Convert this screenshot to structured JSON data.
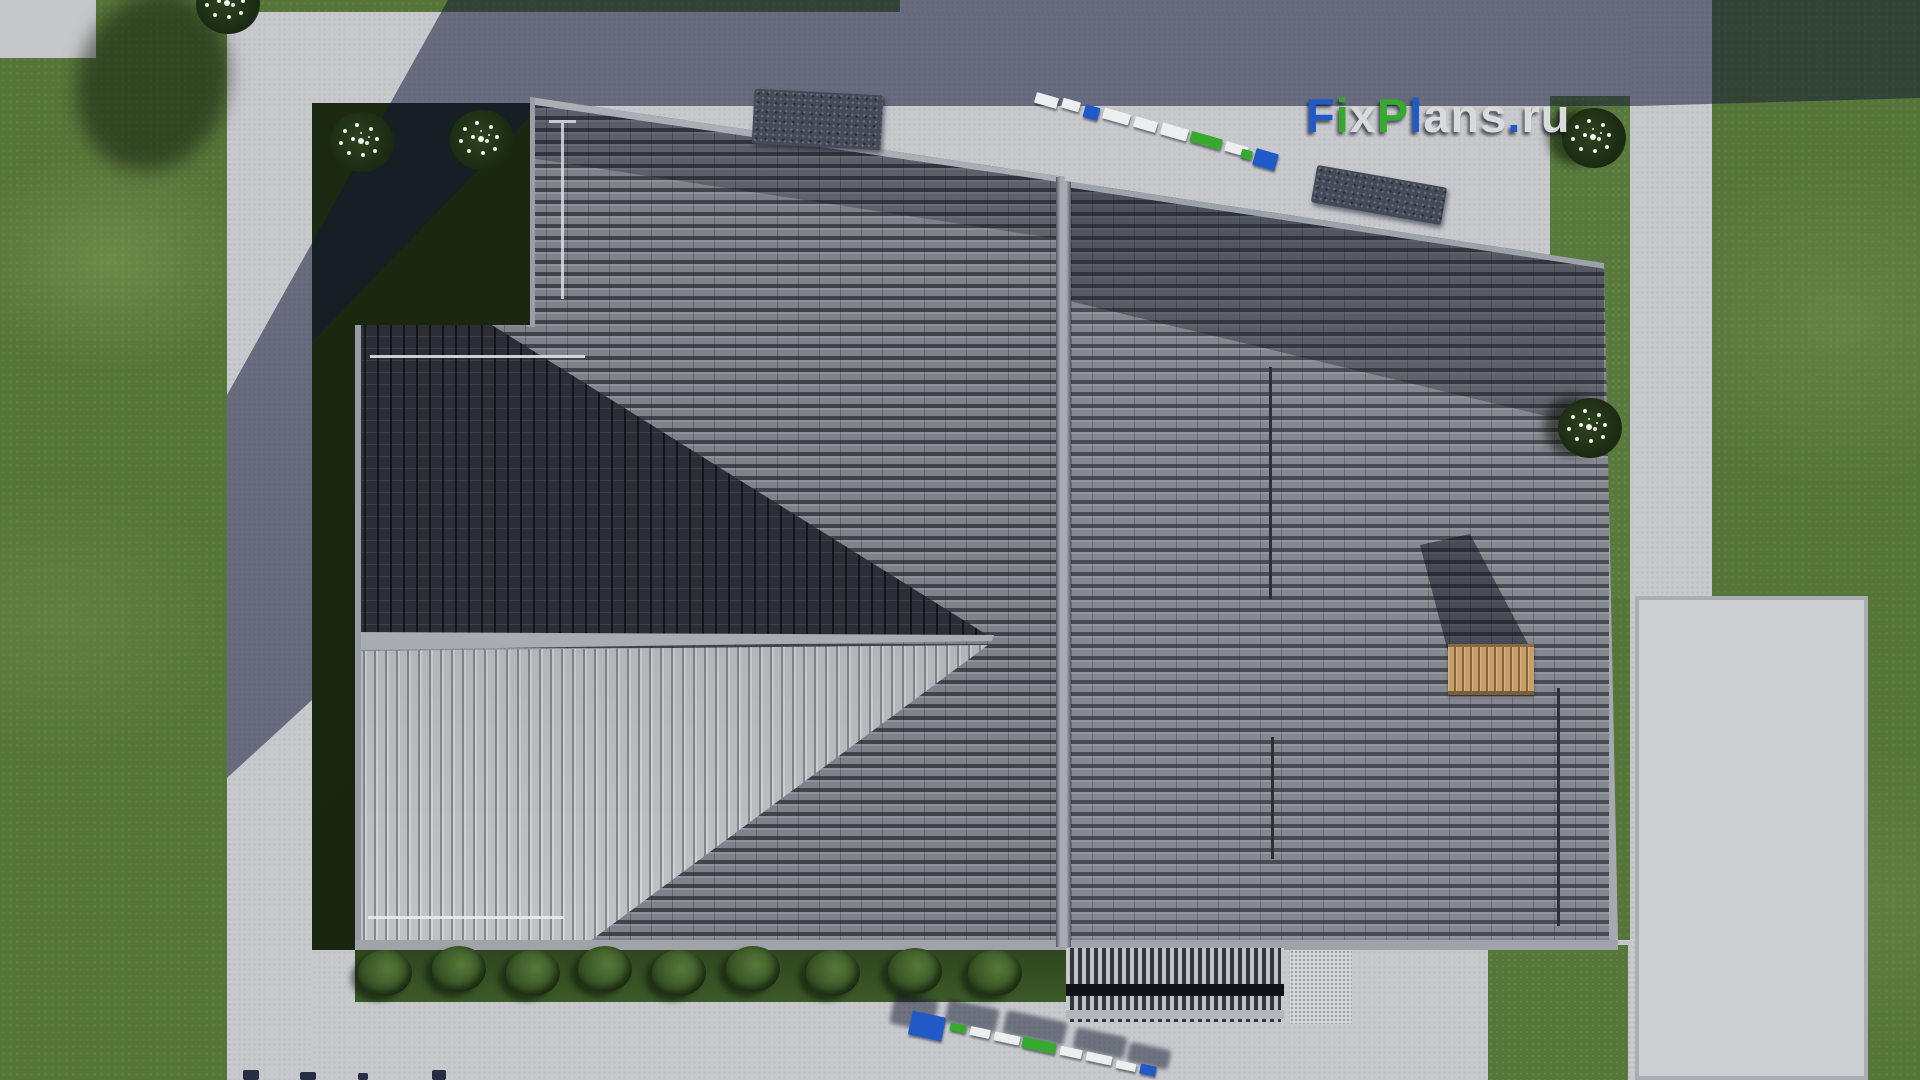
{
  "meta": {
    "description": "Top-down 3D architectural render of a house roof with surrounding lawn, concrete paths and patio",
    "site_watermark": "FixPlans.ru"
  },
  "logo": {
    "text": "FixPlans.ru",
    "letters": [
      {
        "ch": "F",
        "color": "blue"
      },
      {
        "ch": "i",
        "color": "green"
      },
      {
        "ch": "x",
        "color": "light"
      },
      {
        "ch": "P",
        "color": "green"
      },
      {
        "ch": "l",
        "color": "blue"
      },
      {
        "ch": "a",
        "color": "light"
      },
      {
        "ch": "n",
        "color": "light"
      },
      {
        "ch": "s",
        "color": "light"
      },
      {
        "ch": ".",
        "color": "blue"
      },
      {
        "ch": "r",
        "color": "light"
      },
      {
        "ch": "u",
        "color": "light"
      }
    ]
  },
  "watermark_objects": {
    "top_paving_letters": "FixPlans.ru 3D letters lying on paving (seen edge-on)",
    "bottom_paving_letters": "FixPlans.ru 3D letters lying on paving (seen edge-on)",
    "bottom_edge_partial": "partially visible letter tops at image bottom edge"
  },
  "palette": {
    "logo_blue": "#1f5ac8",
    "logo_green": "#35aa2e",
    "logo_light": "#d9dadc",
    "grass": "#567539",
    "grass_shadow": "#16220e",
    "paving": "#c8c9cd",
    "roof_main": "#7f828a",
    "roof_dark_slope": "#2b2e35",
    "roof_light_stripes": "#aeb0b5",
    "ridge_cap": "#a8abb1",
    "chimney_wood": "#c79f69",
    "stone_slab": "#434a58"
  }
}
